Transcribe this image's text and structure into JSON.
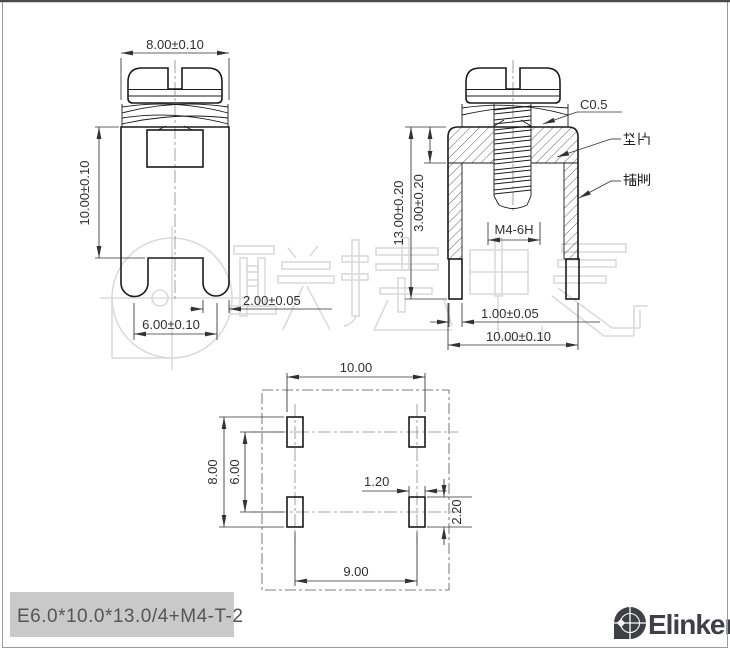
{
  "watermark": "联捷电气",
  "front": {
    "width": "8.00±0.10",
    "height": "10.00±0.10",
    "leg_span": "6.00±0.10",
    "leg_width": "2.00±0.05"
  },
  "section": {
    "total_height": "13.00±0.20",
    "washer_height": "3.00±0.20",
    "chamfer": "C0.5",
    "thread": "M4-6H",
    "leg_thickness": "1.00±0.05",
    "width": "10.00±0.10",
    "washer_label": "垫片",
    "pin_label": "插脚"
  },
  "bottom": {
    "outer_width": "10.00",
    "pitch_x": "9.00",
    "outer_height": "8.00",
    "pitch_y": "6.00",
    "pin_width": "1.20",
    "pin_depth": "2.20"
  },
  "footer": {
    "part_code": "E6.0*10.0*13.0/4+M4-T-2",
    "brand": "Elinker"
  }
}
